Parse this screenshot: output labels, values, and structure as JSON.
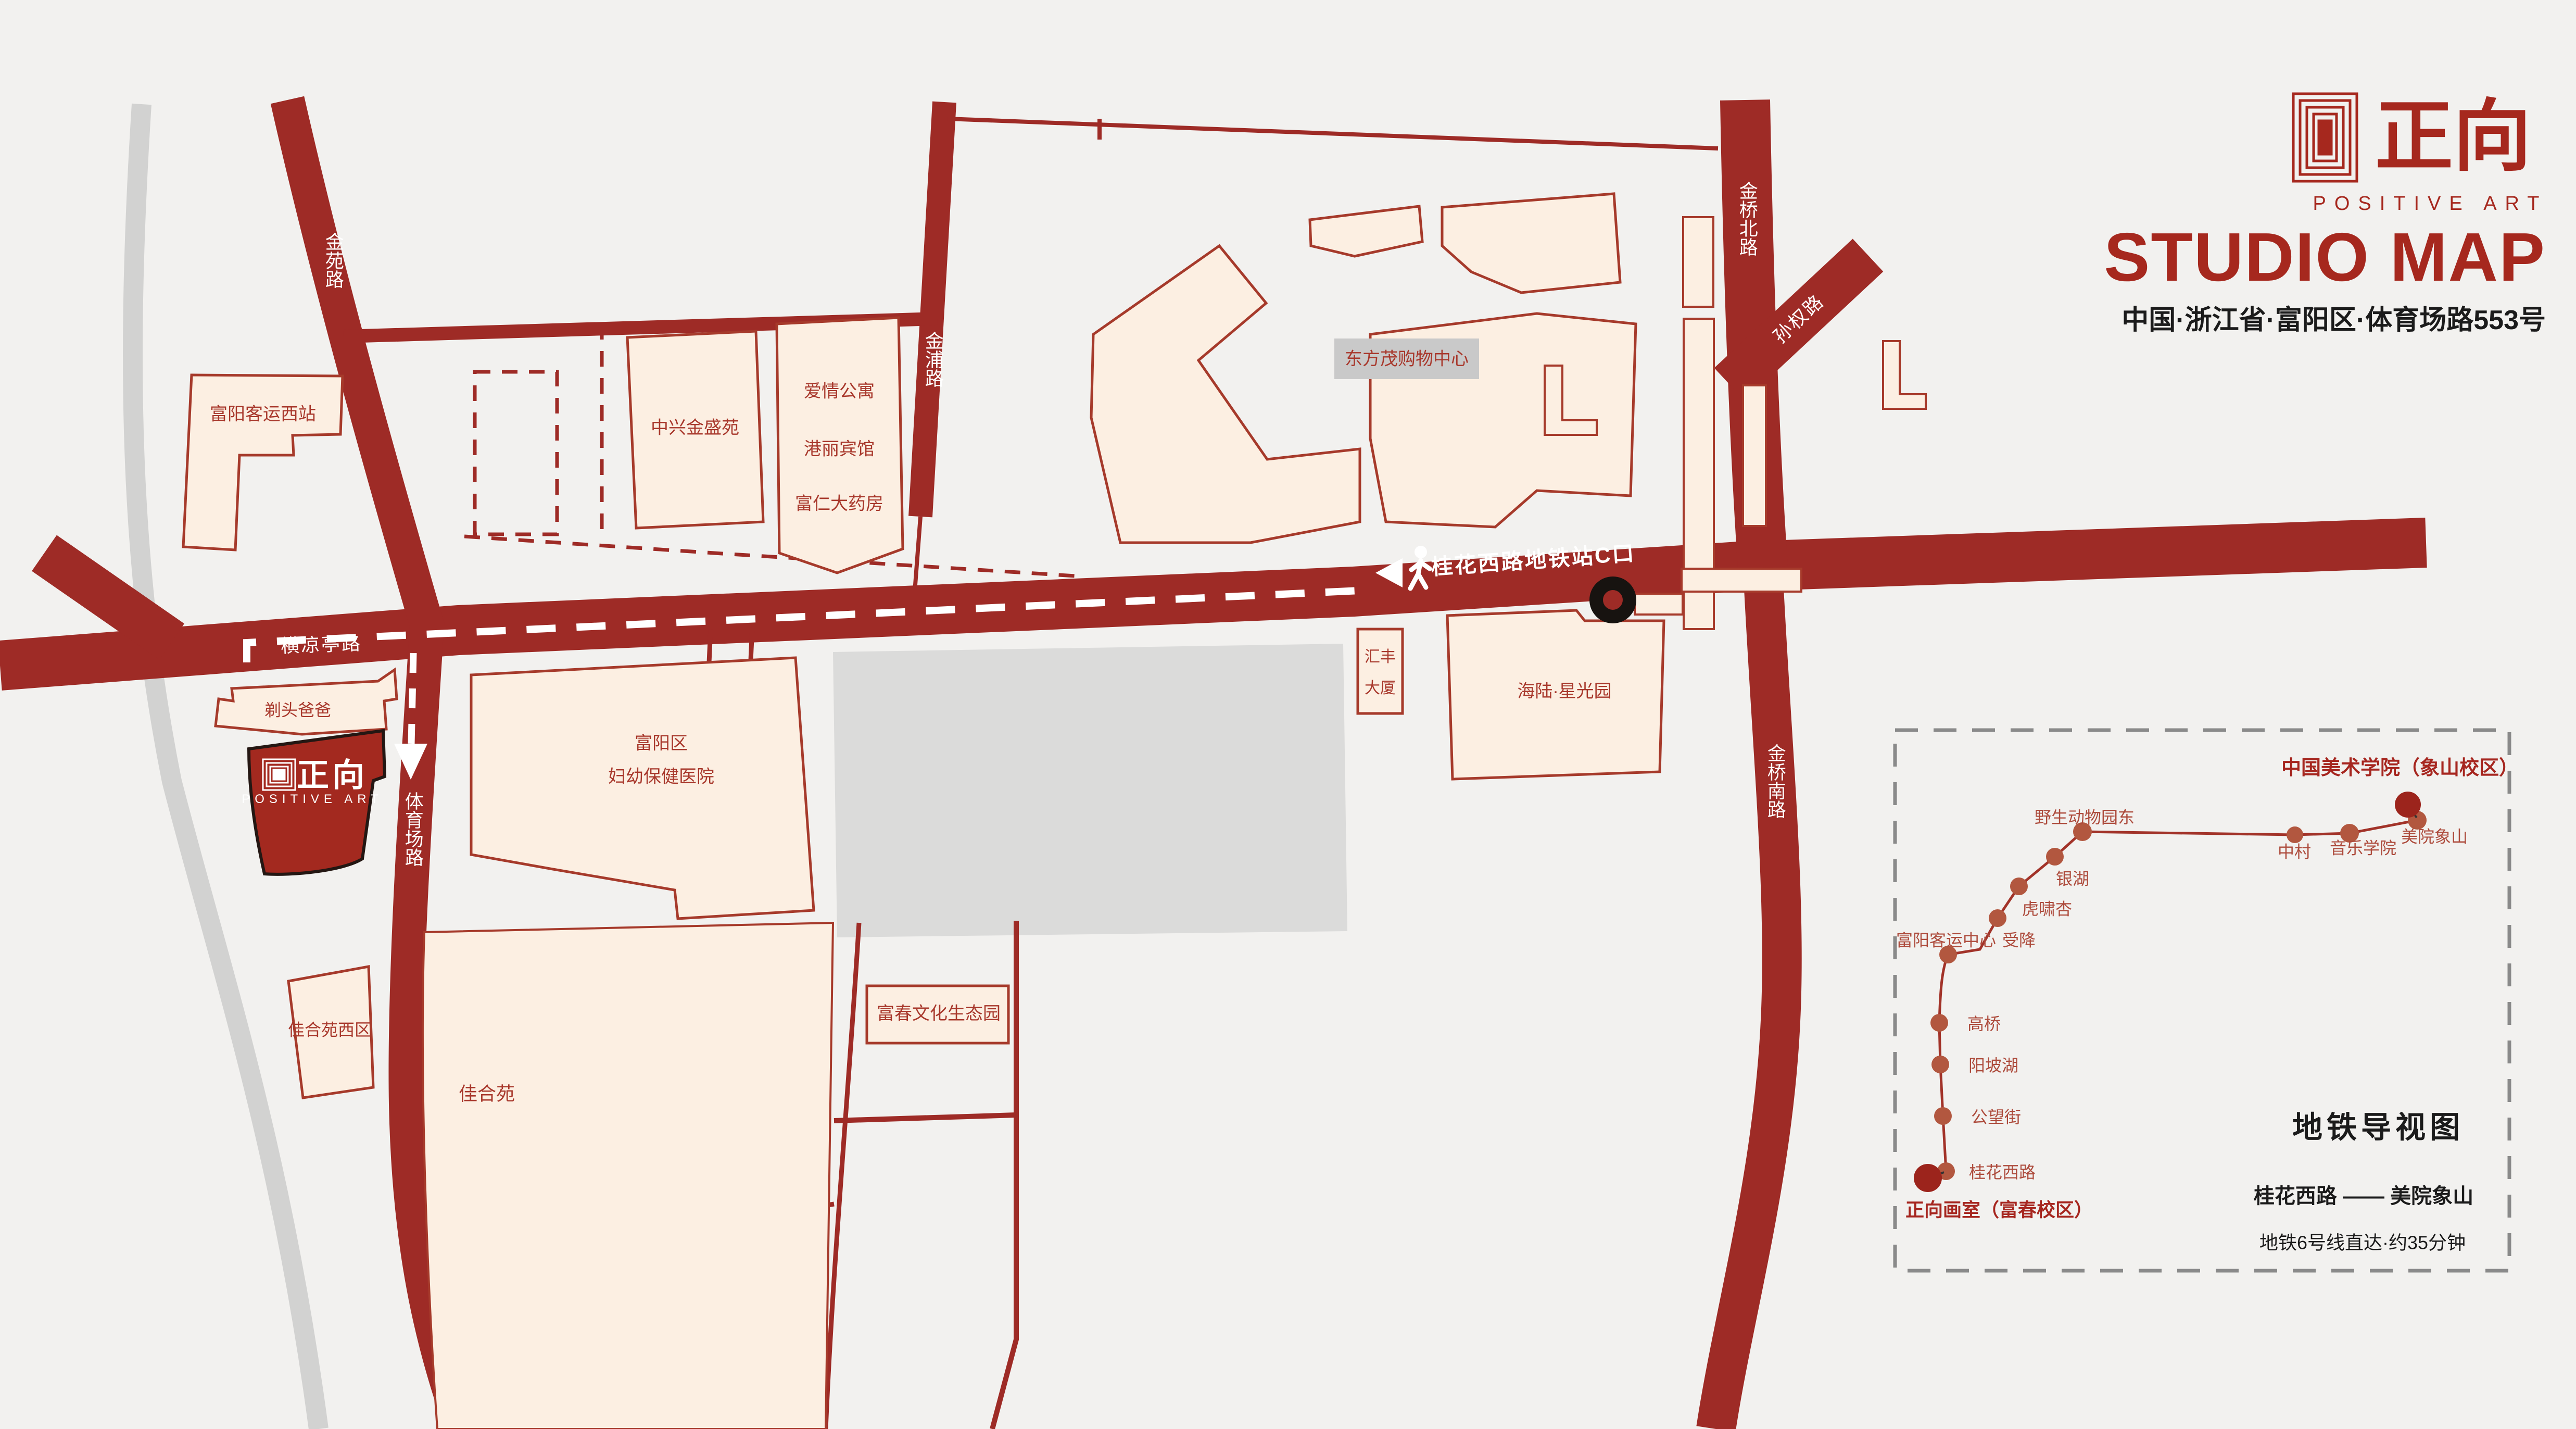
{
  "header": {
    "logo_text": "正向",
    "logo_subtext": "POSITIVE ART",
    "title": "STUDIO MAP",
    "address": "中国·浙江省·富阳区·体育场路553号"
  },
  "roads": {
    "jinyuan": "金苑路",
    "jinpu": "金浦路",
    "jinqiao_north": "金桥北路",
    "sunquan": "孙权路",
    "jinqiao_south": "金桥南路",
    "hengliangting": "横凉亭路",
    "tiyuchang": "体育场路"
  },
  "route": {
    "metro_exit_label": "桂花西路地铁站C口"
  },
  "buildings": {
    "fuyang_west_bus_station": "富阳客运西站",
    "zhongxing_jinsheng_yuan": "中兴金盛苑",
    "aiqing_gongyu": "爱情公寓",
    "gangli_binguan": "港丽宾馆",
    "furen_dayaofang": "富仁大药房",
    "dongfangmao": "东方茂购物中心",
    "huifeng_line1": "汇丰",
    "huifeng_line2": "大厦",
    "hailu_xingguangyuan": "海陆·星光园",
    "hospital_line1": "富阳区",
    "hospital_line2": "妇幼保健医院",
    "titou_baba": "剃头爸爸",
    "jiaheyuan_west": "佳合苑西区",
    "jiaheyuan": "佳合苑",
    "fuchun_park": "富春文化生态园"
  },
  "studio": {
    "logo_text": "正向",
    "logo_subtext": "POSITIVE ART"
  },
  "inset": {
    "title": "地铁导视图",
    "route_endpoints": "桂花西路 —— 美院象山",
    "route_note": "地铁6号线直达·约35分钟",
    "destination": "中国美术学院（象山校区）",
    "origin": "正向画室（富春校区）",
    "stations": [
      {
        "name": "桂花西路"
      },
      {
        "name": "公望街"
      },
      {
        "name": "阳坡湖"
      },
      {
        "name": "高桥"
      },
      {
        "name": "富阳客运中心"
      },
      {
        "name": "受降"
      },
      {
        "name": "虎啸杏"
      },
      {
        "name": "银湖"
      },
      {
        "name": "野生动物园东"
      },
      {
        "name": "中村"
      },
      {
        "name": "音乐学院"
      },
      {
        "name": "美院象山"
      }
    ]
  },
  "colors": {
    "background": "#f2f1ef",
    "road": "#9e2b26",
    "building_fill": "#fcefe2",
    "building_stroke": "#a63a2b",
    "accent_red": "#a6281e",
    "metro_line": "#a23329",
    "station_dot": "#b2573f",
    "river_gray": "#d2d2d1"
  }
}
